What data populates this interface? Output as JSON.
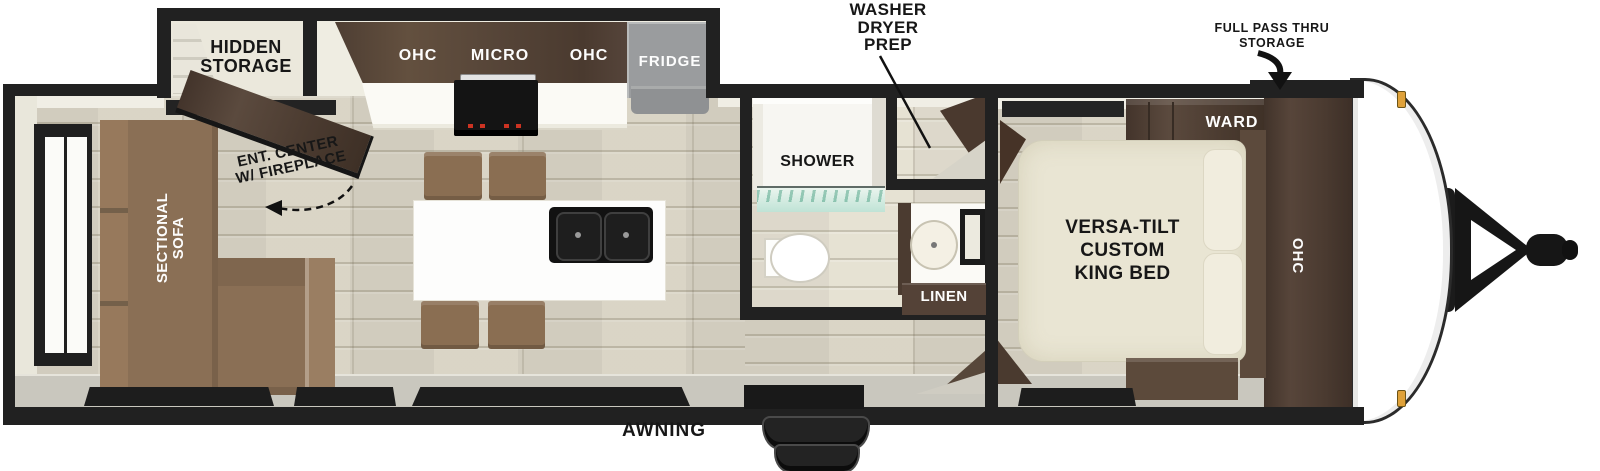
{
  "title": "RV travel trailer floorplan",
  "labels": {
    "washer_dryer_prep": "WASHER\nDRYER\nPREP",
    "full_pass_thru_storage": "FULL PASS THRU\nSTORAGE",
    "hidden_storage": "HIDDEN\nSTORAGE",
    "ohc_left": "OHC",
    "micro": "MICRO",
    "ohc_right": "OHC",
    "fridge": "FRIDGE",
    "ent_center": "ENT. CENTER\nW/ FIREPLACE",
    "sectional_sofa": "SECTIONAL\nSOFA",
    "shower": "SHOWER",
    "linen": "LINEN",
    "king_bed": "VERSA-TILT\nCUSTOM\nKING BED",
    "ward": "WARD",
    "bedroom_ohc": "OHC",
    "awning": "AWNING"
  },
  "colors": {
    "wall": "#212121",
    "floor": "#d8d3c4",
    "dark_wood": "#4c3c31",
    "sofa_brown": "#8a6f55",
    "bed_cream": "#e9e5d3",
    "fridge_gray": "#9a9c9e",
    "marker_light": "#dfa139",
    "shower_glass": "#bfe3d6"
  }
}
